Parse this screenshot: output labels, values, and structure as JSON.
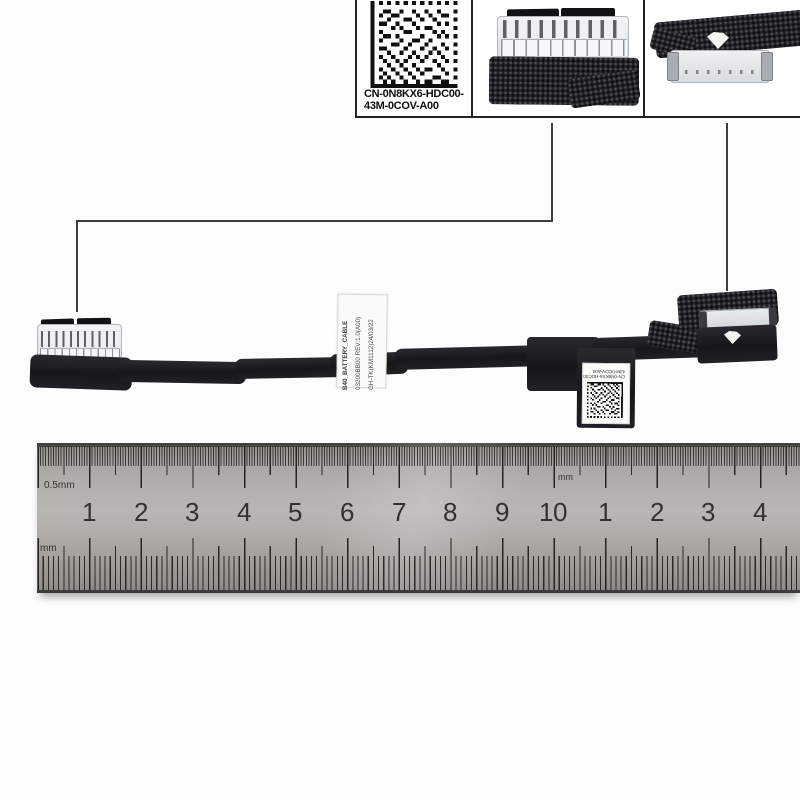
{
  "photo": {
    "description": "Dell battery cable product photo with callout close-ups and metal ruler"
  },
  "callouts": {
    "part_label": {
      "line1": "CN-0N8KX6-HDC00-",
      "line2": "43M-0COV-A00"
    }
  },
  "cable": {
    "sticker_lines": [
      "B40_BATTERY_CABLE",
      "03200BB00  REV:1.0(A00)",
      "GH-TK(KM1112)24/03/22"
    ],
    "flag_label": {
      "line1": "CN-0N8KX6-HDC00",
      "line2": "43M-0COV-A00"
    }
  },
  "ruler": {
    "unit_top_left": "0.5mm",
    "unit_bottom_left": "mm",
    "unit_top_mid": "mm",
    "numbers": [
      {
        "label": "1",
        "x": 89
      },
      {
        "label": "2",
        "x": 141
      },
      {
        "label": "3",
        "x": 192
      },
      {
        "label": "4",
        "x": 244
      },
      {
        "label": "5",
        "x": 295
      },
      {
        "label": "6",
        "x": 347
      },
      {
        "label": "7",
        "x": 399
      },
      {
        "label": "8",
        "x": 450
      },
      {
        "label": "9",
        "x": 502
      },
      {
        "label": "10",
        "x": 553
      },
      {
        "label": "1",
        "x": 605
      },
      {
        "label": "2",
        "x": 657
      },
      {
        "label": "3",
        "x": 708
      },
      {
        "label": "4",
        "x": 760
      }
    ]
  },
  "colors": {
    "ruler_metal": "#b4b2af",
    "cable_black": "#1b1b1e",
    "connector_white": "#e8ebee",
    "line_dark": "#3e3e3e"
  }
}
